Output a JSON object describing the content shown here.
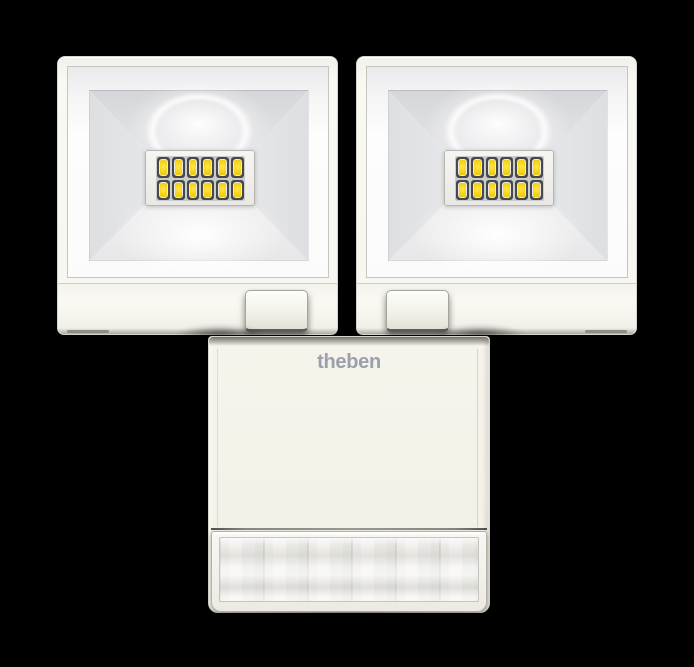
{
  "product": {
    "brand_logo": "theben",
    "description": "Twin-head LED floodlight with PIR motion detector, white housing",
    "floodlights": {
      "count": 2,
      "labels": [
        "left floodlight head",
        "right floodlight head"
      ]
    },
    "led_grid": {
      "rows": 2,
      "cols": 6,
      "leds_per_head": 12
    },
    "sensor": {
      "part": "PIR motion detector with fresnel lens"
    },
    "colors": {
      "bg": "#000000",
      "housing": "#f7f6f0",
      "housing-cream": "#f4f2e8",
      "led-yellow": "#f6d51a",
      "led-frame": "#46484d",
      "logo-grey": "#9aa1ad",
      "lens-grey": "#e8e7e3"
    }
  }
}
